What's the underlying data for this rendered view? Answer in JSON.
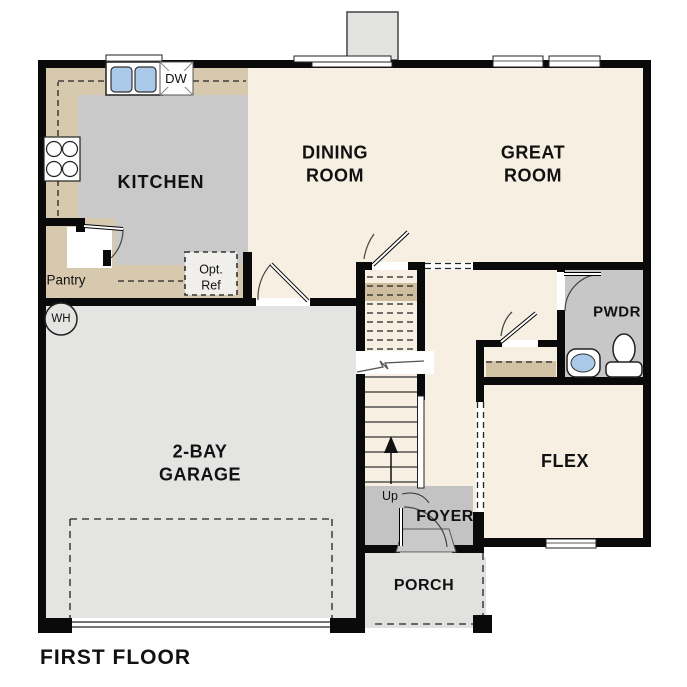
{
  "plan": {
    "title": "FIRST FLOOR",
    "rooms": {
      "kitchen": "KITCHEN",
      "dining_room": "DINING\nROOM",
      "great_room": "GREAT\nROOM",
      "garage": "2-BAY\nGARAGE",
      "powder_room": "PWDR",
      "flex": "FLEX",
      "foyer": "FOYER",
      "porch": "PORCH",
      "pantry": "Pantry"
    },
    "annotations": {
      "dishwasher": "DW",
      "water_heater": "WH",
      "optional_refrigerator": "Opt.\nRef",
      "stairs_up": "Up"
    },
    "colors": {
      "floor_living": "#f7efe2",
      "floor_kitchen": "#c9c9c9",
      "floor_garage": "#e4e4e3",
      "floor_porch": "#e1e1df",
      "floor_foyer": "#c3c3c3",
      "floor_powder": "#c7c7c7",
      "counter_tan": "#d7c9ad",
      "stair_landing_tan": "#cfbda0",
      "wall": "#0a0a0a",
      "sink_blue": "#aac9e9"
    }
  }
}
